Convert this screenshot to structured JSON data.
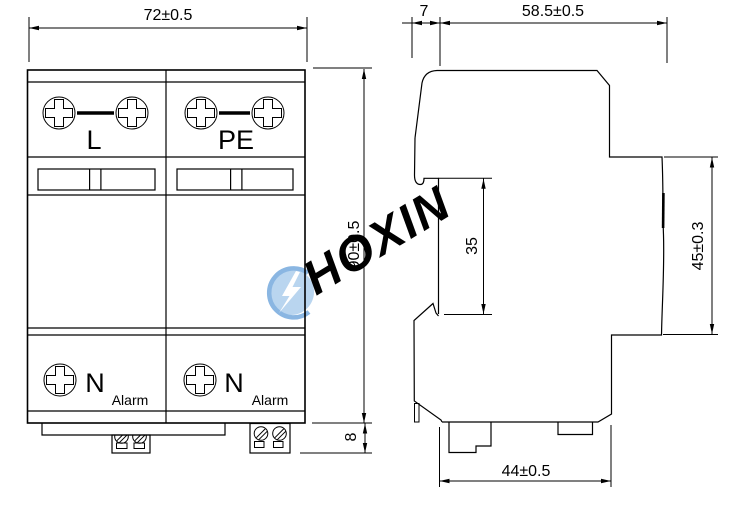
{
  "front": {
    "width_dim": "72±0.5",
    "height_dim": "90±0.5",
    "base_dim": "8",
    "module1_top": "L",
    "module2_top": "PE",
    "module1_bottom": "N",
    "module2_bottom": "N",
    "module1_alarm": "Alarm",
    "module2_alarm": "Alarm"
  },
  "side": {
    "offset_dim": "7",
    "depth_dim": "58.5±0.5",
    "rail_dim": "35",
    "height_dim": "45±0.3",
    "base_dim": "44±0.5"
  },
  "watermark": {
    "brand": "HOXIN"
  },
  "colors": {
    "indicator_green": "#00ee00",
    "line": "#000000",
    "watermark_light": "#c3dcf2",
    "watermark_circle": "#b9d5ef",
    "watermark_mid": "#8ab6e2",
    "bolt_white": "#ffffff"
  }
}
